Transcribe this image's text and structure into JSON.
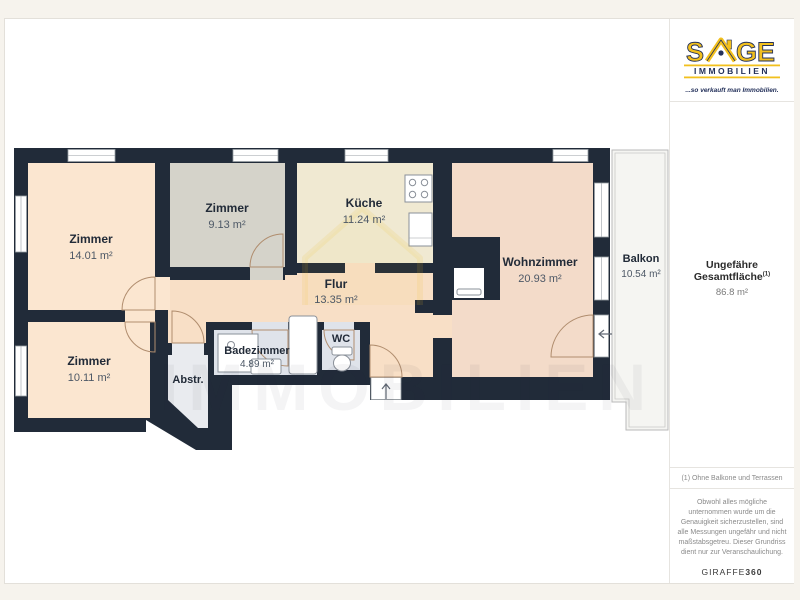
{
  "colors": {
    "wall": "#212b39",
    "peach": "#fbe6d0",
    "flur": "#f8dfc6",
    "wohn": "#f3dbc9",
    "gray": "#d5d3ca",
    "cream": "#f0e9d2",
    "bath": "#dfe3ea",
    "abstr": "#e9ebef",
    "balc": "#f5f5f2",
    "accent": "#f2c01e",
    "navy": "#23305a",
    "ink": "#222b38",
    "muted": "#4d5866"
  },
  "brand": {
    "name_start": "S",
    "name_end": "GE",
    "sub": "IMMOBILIEN",
    "tagline": "...so verkauft man Immobilien."
  },
  "sidebar": {
    "total_label": "Ungefähre Gesamtfläche",
    "total_sup": "(1)",
    "total_value": "86.8 m²",
    "footnote": "(1) Ohne Balkone und Terrassen",
    "disclaimer": "Obwohl alles mögliche unternommen wurde um die Genauigkeit sicherzustellen, sind alle Messungen ungefähr und nicht maßstabsgetreu. Dieser Grundriss dient nur zur Veranschaulichung.",
    "credit_name": "GIRAFFE",
    "credit_bold": "360"
  },
  "floorplan": {
    "watermark": "IMMOBILIEN",
    "rooms": {
      "zimmer1": {
        "name": "Zimmer",
        "area": "14.01 m²"
      },
      "zimmer2": {
        "name": "Zimmer",
        "area": "9.13 m²"
      },
      "zimmer3": {
        "name": "Zimmer",
        "area": "10.11 m²"
      },
      "kueche": {
        "name": "Küche",
        "area": "11.24 m²"
      },
      "wohnzimmer": {
        "name": "Wohnzimmer",
        "area": "20.93 m²"
      },
      "flur": {
        "name": "Flur",
        "area": "13.35 m²"
      },
      "badezimmer": {
        "name": "Badezimmer",
        "area": "4.89 m²"
      },
      "wc": {
        "name": "WC"
      },
      "abstellraum": {
        "name": "Abstr."
      },
      "balkon": {
        "name": "Balkon",
        "area": "10.54 m²"
      }
    }
  }
}
